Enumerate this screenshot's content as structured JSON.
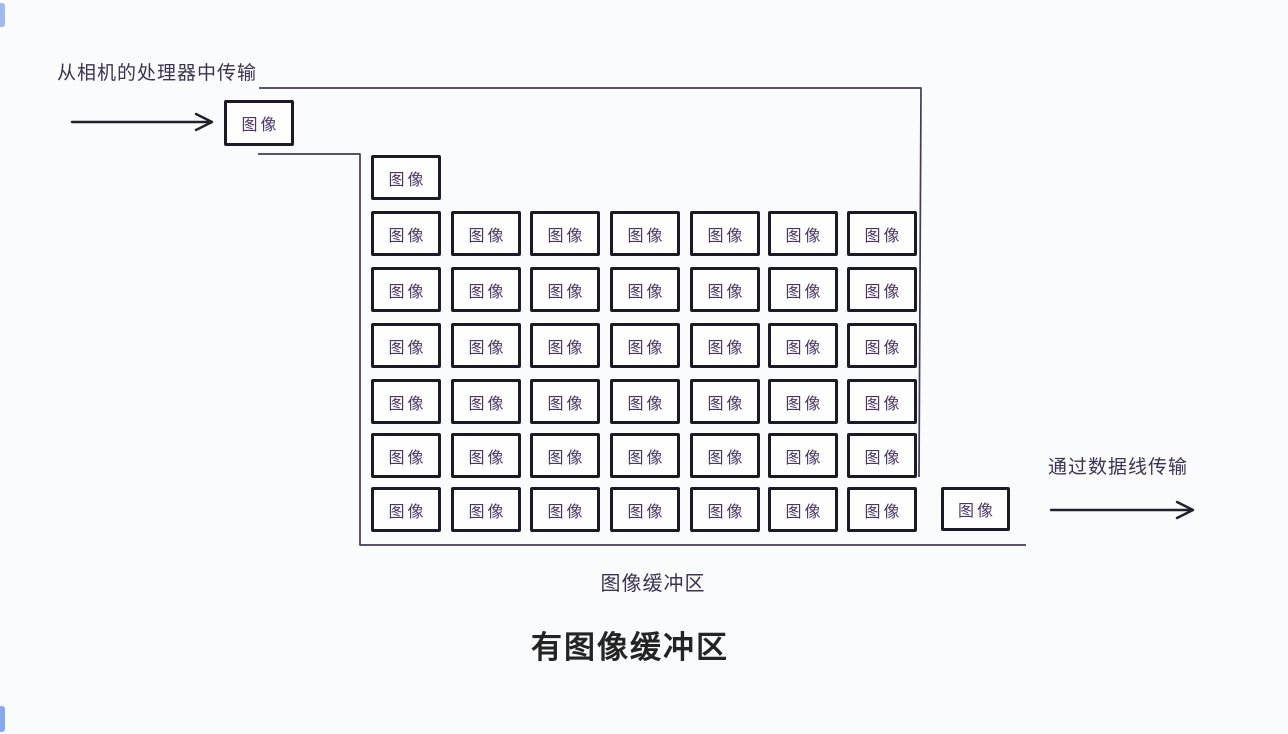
{
  "diagram": {
    "input_caption": "从相机的处理器中传输",
    "output_caption": "通过数据线传输",
    "buffer_caption": "图像缓冲区",
    "title": "有图像缓冲区",
    "box_label": "图像",
    "buffer_grid": {
      "header_boxes": 1,
      "rows": 6,
      "cols": 7,
      "entry_boxes": 1,
      "exit_boxes": 1,
      "total_boxes_in_buffer": 43
    },
    "colors": {
      "background": "#fafbfd",
      "box_border": "#1d1a28",
      "box_text": "#4a3666",
      "outline": "#433a5c",
      "caption": "#3e3252",
      "title": "#242424",
      "arrow": "#23202e",
      "corner_accent": "#5b84e0"
    }
  }
}
